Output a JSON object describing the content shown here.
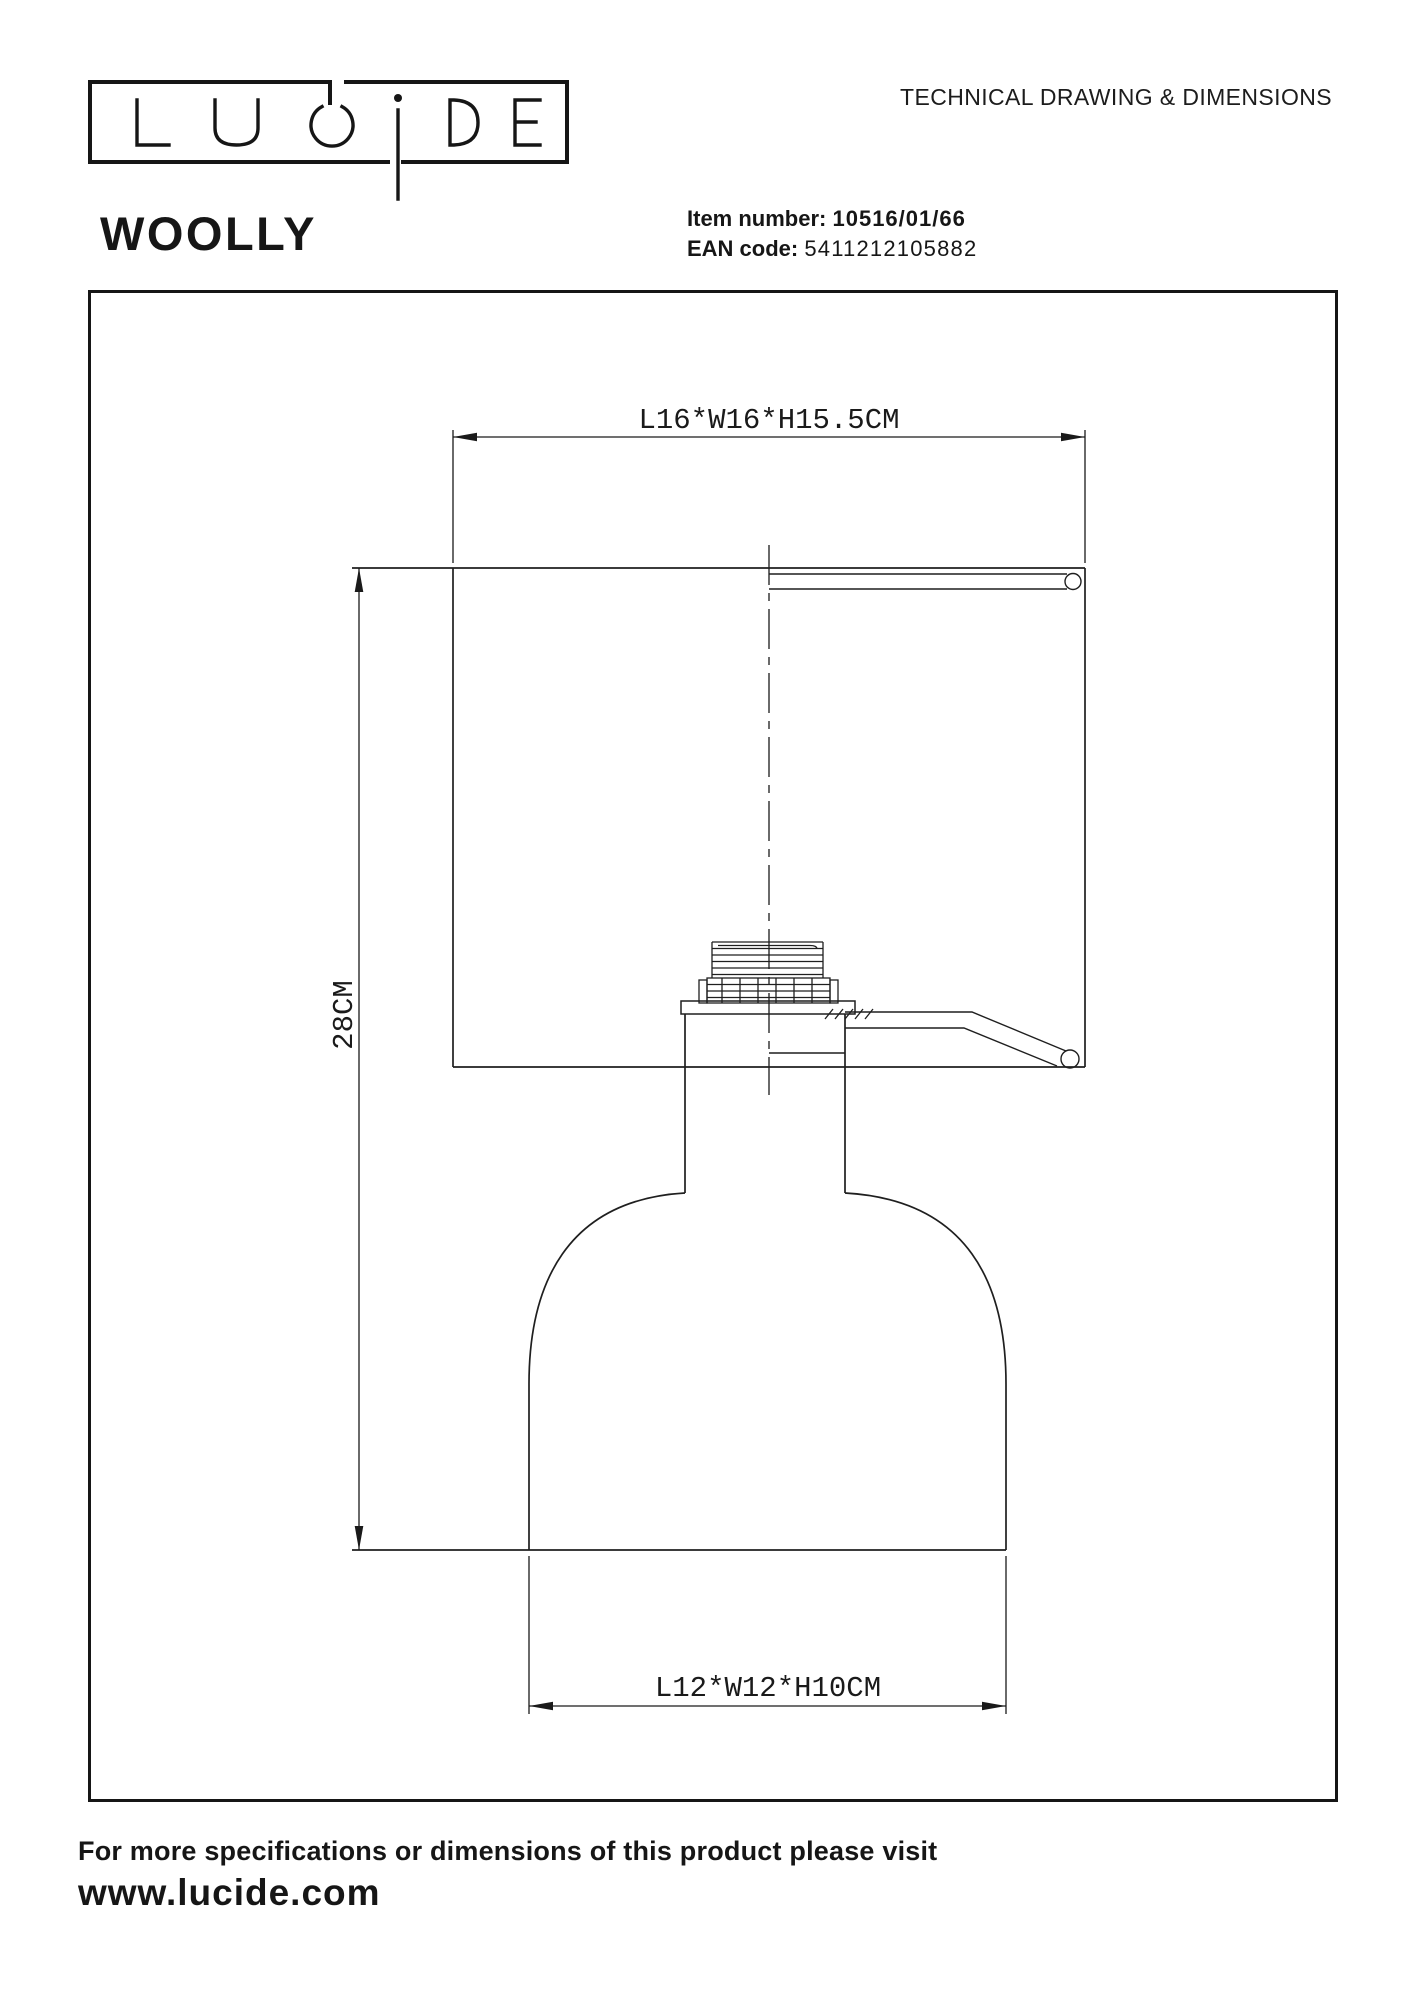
{
  "header": {
    "logo_alt": "LUCIDE",
    "page_title": "TECHNICAL DRAWING & DIMENSIONS"
  },
  "product": {
    "name": "WOOLLY",
    "item_number_label": "Item number:",
    "item_number": "10516/01/66",
    "ean_label": "EAN code:",
    "ean": "5411212105882"
  },
  "drawing": {
    "dim_shade": "L16*W16*H15.5CM",
    "dim_height": "28CM",
    "dim_base": "L12*W12*H10CM"
  },
  "footer": {
    "line1": "For more specifications or dimensions of this product please visit",
    "website": "www.lucide.com"
  },
  "colors": {
    "ink": "#161616",
    "background": "#ffffff"
  }
}
